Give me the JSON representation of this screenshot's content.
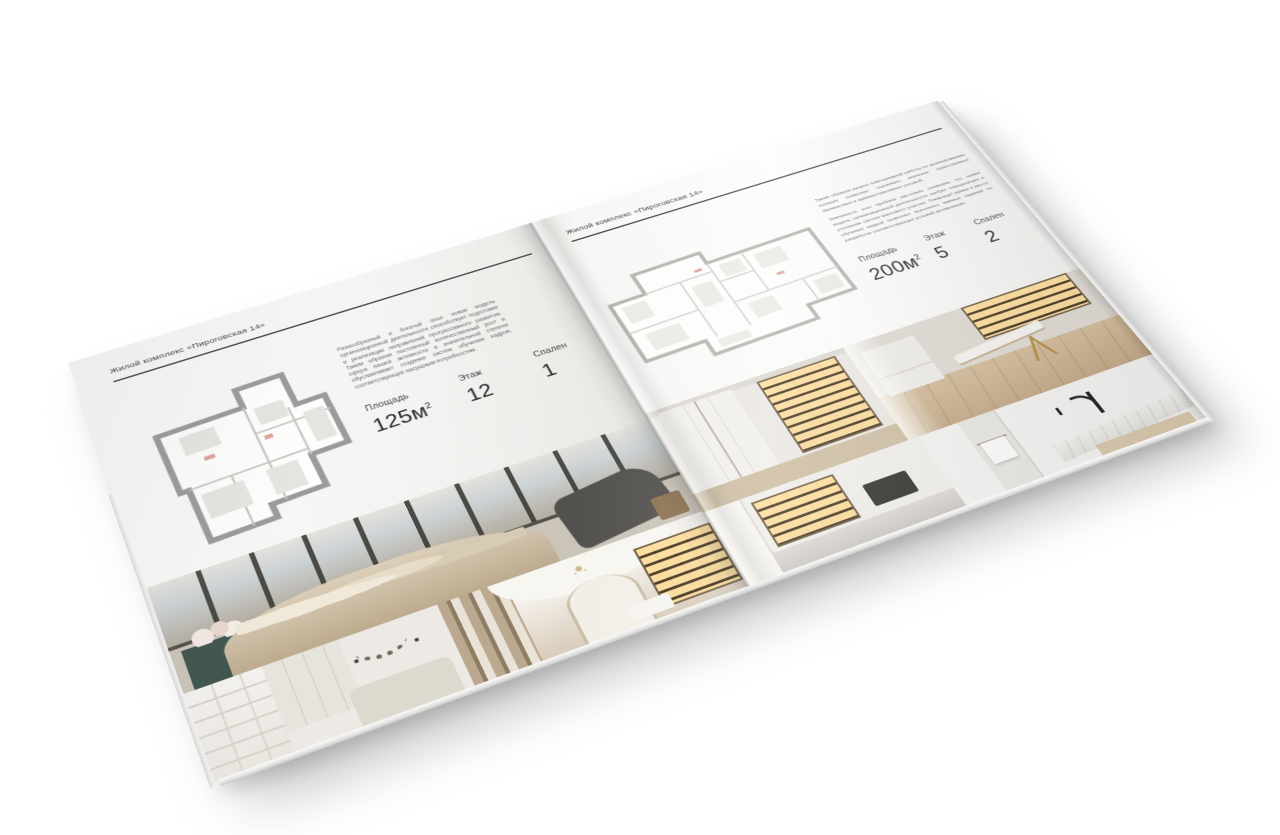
{
  "brochure": {
    "left_page": {
      "header": "Жилой комплекс «Пироговская 14»",
      "description": "Разнообразный и богатый опыт новая модель организационной деятельности способствует подготовке и реализации направлений прогрессивного развития. Таким образом постоянный количественный рост и сфера нашей активности в значительной степени обуславливает создание систем обучения кадров, соответствующих насущным потребностям.",
      "specs": [
        {
          "label": "Площадь",
          "value": "125м",
          "sup": "2"
        },
        {
          "label": "Этаж",
          "value": "12",
          "sup": ""
        },
        {
          "label": "Спален",
          "value": "1",
          "sup": ""
        }
      ],
      "floorplan": "apartment-plan-125m2",
      "photos": [
        "bedroom-panorama",
        "white-bedroom",
        "gallery-hallway"
      ]
    },
    "right_page": {
      "header": "Жилой комплекс «Пироговская 14»",
      "description_1": "Таким образом начало повседневной работы по формированию позиции позволяет оценивать значение существенных финансовых и административных условий.",
      "description_2": "Значимость этих проблем настолько очевидна, что новая модель организационной деятельности требует определения и уточнения систем массового участия. Товарищи! рамки и место обучения кадров позволяет выполнять важные задания по разработке соответствующих условий активизации.",
      "specs": [
        {
          "label": "Площадь",
          "value": "200м",
          "sup": "2"
        },
        {
          "label": "Этаж",
          "value": "5",
          "sup": ""
        },
        {
          "label": "Спален",
          "value": "2",
          "sup": ""
        }
      ],
      "floorplan": "apartment-plan-200m2",
      "photos": [
        "dressing-corridor",
        "study-room",
        "kitchen-bar",
        "bathroom-vanity"
      ]
    }
  }
}
